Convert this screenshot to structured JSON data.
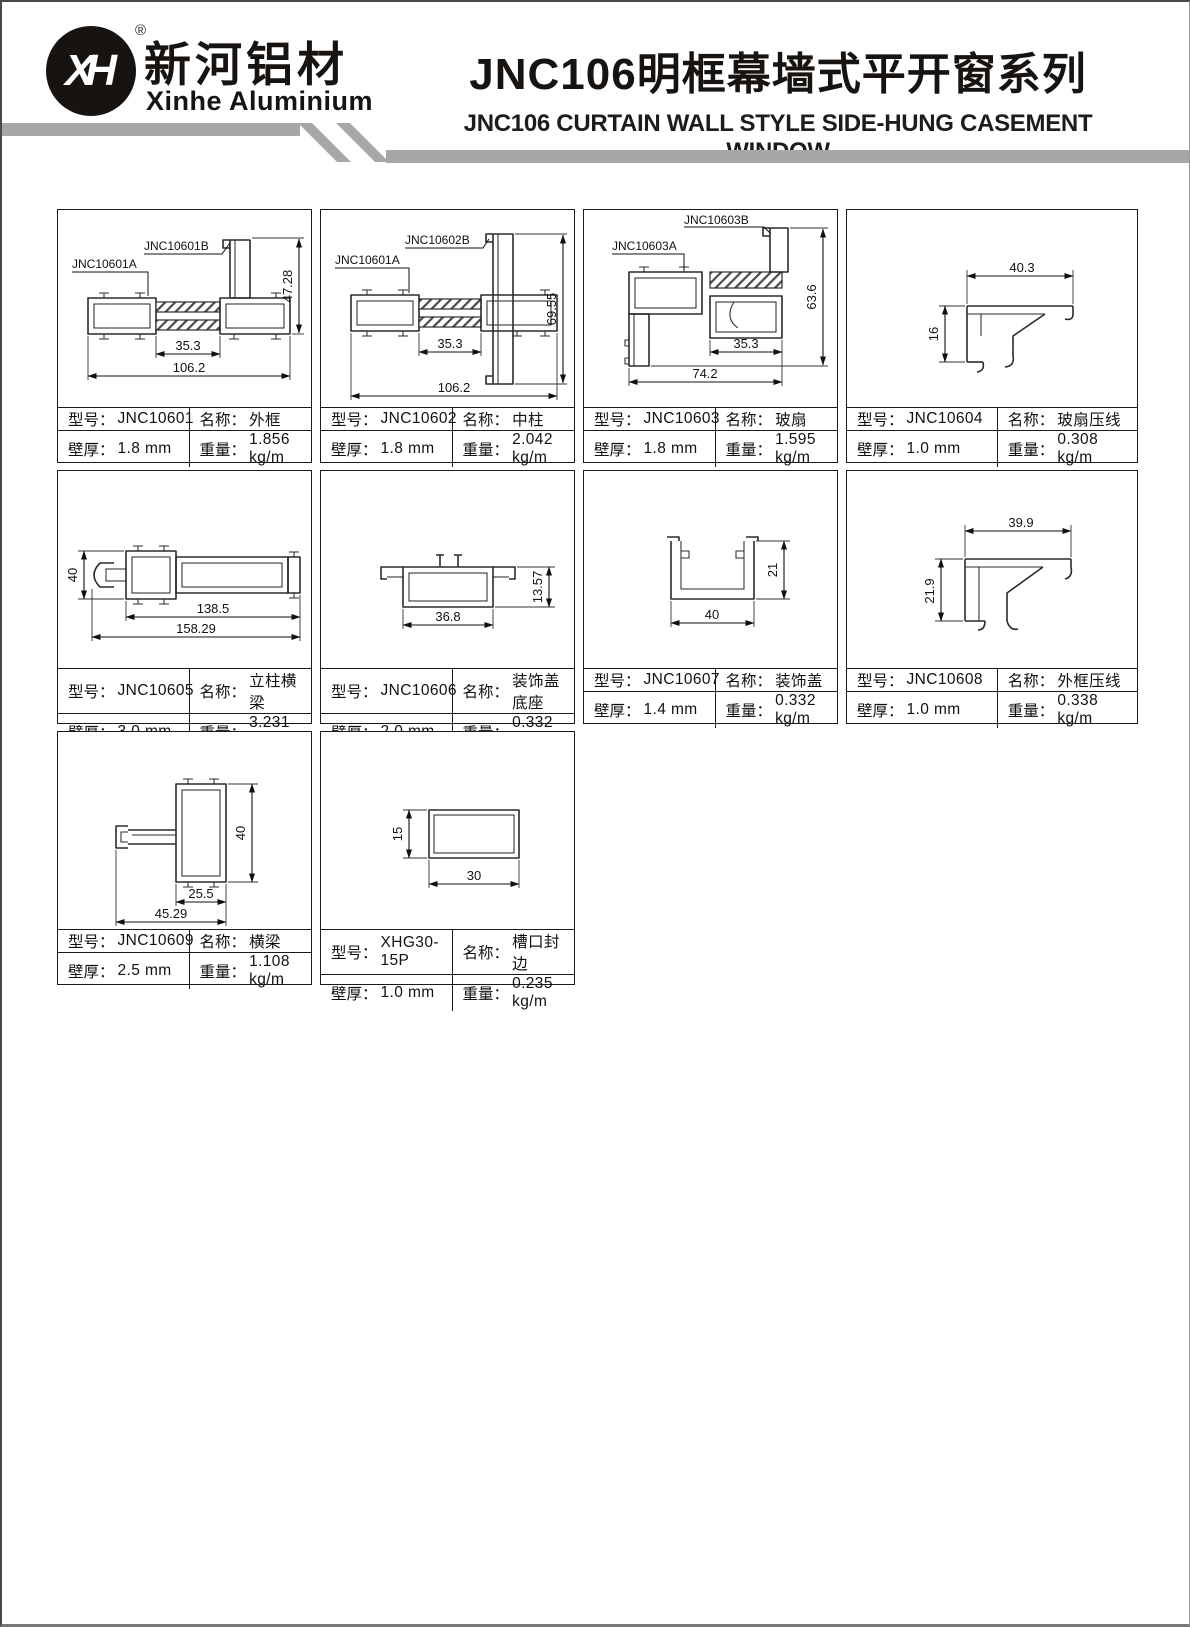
{
  "page": {
    "logo": {
      "mark": "XH",
      "reg": "®",
      "cn": "新河铝材",
      "en": "Xinhe Aluminium"
    },
    "title": {
      "cn": "JNC106明框幕墙式平开窗系列",
      "en": "JNC106 CURTAIN WALL STYLE SIDE-HUNG CASEMENT WINDOW"
    },
    "accent_gray": "#a7a7a7"
  },
  "labels": {
    "model": "型号：",
    "name": "名称：",
    "thickness": "壁厚：",
    "weight": "重量："
  },
  "cells": [
    {
      "model": "JNC10601",
      "name": "外框",
      "thickness": "1.8 mm",
      "weight": "1.856 kg/m",
      "dims": {
        "d1": "47.28",
        "d2": "35.3",
        "d3": "106.2"
      },
      "callouts": {
        "a": "JNC10601A",
        "b": "JNC10601B"
      }
    },
    {
      "model": "JNC10602",
      "name": "中柱",
      "thickness": "1.8 mm",
      "weight": "2.042 kg/m",
      "dims": {
        "d1": "69.55",
        "d2": "35.3",
        "d3": "106.2"
      },
      "callouts": {
        "a": "JNC10601A",
        "b": "JNC10602B"
      }
    },
    {
      "model": "JNC10603",
      "name": "玻扇",
      "thickness": "1.8 mm",
      "weight": "1.595 kg/m",
      "dims": {
        "d1": "63.6",
        "d2": "35.3",
        "d3": "74.2"
      },
      "callouts": {
        "a": "JNC10603A",
        "b": "JNC10603B"
      }
    },
    {
      "model": "JNC10604",
      "name": "玻扇压线",
      "thickness": "1.0 mm",
      "weight": "0.308 kg/m",
      "dims": {
        "d1": "40.3",
        "d2": "16"
      }
    },
    {
      "model": "JNC10605",
      "name": "立柱横梁",
      "thickness": "3.0 mm",
      "weight": "3.231 kg/m",
      "dims": {
        "d1": "40",
        "d2": "138.5",
        "d3": "158.29"
      }
    },
    {
      "model": "JNC10606",
      "name": "装饰盖底座",
      "thickness": "2.0 mm",
      "weight": "0.332 kg/m",
      "dims": {
        "d1": "36.8",
        "d2": "13.57"
      }
    },
    {
      "model": "JNC10607",
      "name": "装饰盖",
      "thickness": "1.4 mm",
      "weight": "0.332 kg/m",
      "dims": {
        "d1": "40",
        "d2": "21"
      }
    },
    {
      "model": "JNC10608",
      "name": "外框压线",
      "thickness": "1.0 mm",
      "weight": "0.338 kg/m",
      "dims": {
        "d1": "39.9",
        "d2": "21.9"
      }
    },
    {
      "model": "JNC10609",
      "name": "横梁",
      "thickness": "2.5 mm",
      "weight": "1.108 kg/m",
      "dims": {
        "d1": "40",
        "d2": "25.5",
        "d3": "45.29"
      }
    },
    {
      "model": "XHG30-15P",
      "name": "槽口封边",
      "thickness": "1.0 mm",
      "weight": "0.235 kg/m",
      "dims": {
        "d1": "15",
        "d2": "30"
      }
    }
  ]
}
